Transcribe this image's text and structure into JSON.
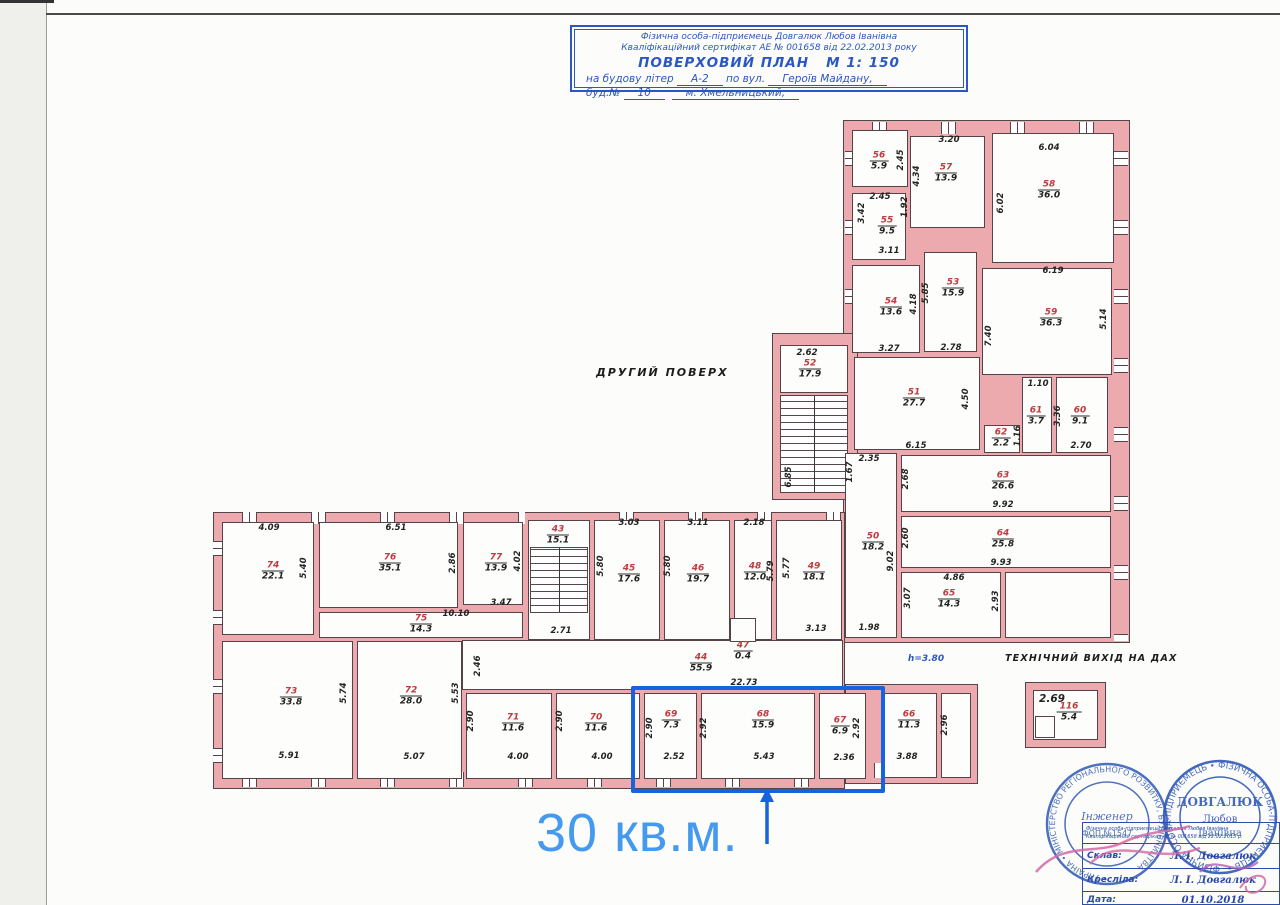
{
  "title": {
    "l1": "Фізична особа-підприємець Довгалюк Любов Іванівна",
    "l2": "Кваліфікаційний сертифікат АЕ № 001658 від 22.02.2013 року",
    "plan_name": "ПОВЕРХОВИЙ ПЛАН",
    "scale": "М 1: 150",
    "l4a": "на будову літер",
    "l4b": "А-2",
    "l4c": "по вул.",
    "l4d": "Героїв Майдану,",
    "l5a": "буд.№",
    "l5b": "10",
    "l5c": "м. Хмельницький,"
  },
  "plan": {
    "floor_label": "ДРУГИЙ ПОВЕРХ",
    "roof_exit_label": "ТЕХНІЧНИЙ ВИХІД НА ДАХ",
    "height_note": "h=3.80"
  },
  "annotation": {
    "area_text": "30 кв.м."
  },
  "rooms": [
    {
      "n": "56",
      "a": "5.9"
    },
    {
      "n": "57",
      "a": "13.9"
    },
    {
      "n": "58",
      "a": "36.0"
    },
    {
      "n": "55",
      "a": "9.5"
    },
    {
      "n": "54",
      "a": "13.6"
    },
    {
      "n": "53",
      "a": "15.9"
    },
    {
      "n": "59",
      "a": "36.3"
    },
    {
      "n": "52",
      "a": "17.9"
    },
    {
      "n": "51",
      "a": "27.7"
    },
    {
      "n": "61",
      "a": "3.7"
    },
    {
      "n": "60",
      "a": "9.1"
    },
    {
      "n": "62",
      "a": "2.2"
    },
    {
      "n": "63",
      "a": "26.6"
    },
    {
      "n": "64",
      "a": "25.8"
    },
    {
      "n": "50",
      "a": "18.2"
    },
    {
      "n": "65",
      "a": "14.3"
    },
    {
      "n": "74",
      "a": "22.1"
    },
    {
      "n": "76",
      "a": "35.1"
    },
    {
      "n": "77",
      "a": "13.9"
    },
    {
      "n": "75",
      "a": "14.3"
    },
    {
      "n": "43",
      "a": "15.1"
    },
    {
      "n": "45",
      "a": "17.6"
    },
    {
      "n": "46",
      "a": "19.7"
    },
    {
      "n": "48",
      "a": "12.0"
    },
    {
      "n": "49",
      "a": "18.1"
    },
    {
      "n": "73",
      "a": "33.8"
    },
    {
      "n": "72",
      "a": "28.0"
    },
    {
      "n": "71",
      "a": "11.6"
    },
    {
      "n": "70",
      "a": "11.6"
    },
    {
      "n": "69",
      "a": "7.3"
    },
    {
      "n": "68",
      "a": "15.9"
    },
    {
      "n": "67",
      "a": "6.9"
    },
    {
      "n": "66",
      "a": "11.3"
    },
    {
      "n": "44",
      "a": "55.9"
    },
    {
      "n": "47",
      "a": "0.4"
    },
    {
      "n": "116",
      "a": "5.4"
    }
  ],
  "dims": [
    "2.45",
    "2.45",
    "3.20",
    "4.34",
    "6.04",
    "6.02",
    "3.42",
    "1.92",
    "3.11",
    "4.18",
    "3.27",
    "5.85",
    "2.78",
    "6.19",
    "5.14",
    "7.40",
    "2.62",
    "6.85",
    "1.67",
    "4.50",
    "6.15",
    "1.10",
    "1.16",
    "3.36",
    "2.70",
    "2.35",
    "2.68",
    "9.92",
    "2.60",
    "9.93",
    "9.02",
    "4.86",
    "3.07",
    "2.93",
    "1.98",
    "3.13",
    "4.09",
    "5.40",
    "6.51",
    "2.86",
    "4.02",
    "3.47",
    "10.10",
    "2.71",
    "3.03",
    "5.80",
    "3.11",
    "5.80",
    "2.18",
    "5.79",
    "5.77",
    "5.74",
    "5.91",
    "5.53",
    "5.07",
    "2.46",
    "2.90",
    "4.00",
    "2.90",
    "4.00",
    "2.90",
    "2.52",
    "2.92",
    "5.43",
    "2.36",
    "2.92",
    "3.88",
    "2.96",
    "22.73",
    "2.69"
  ],
  "stamps": {
    "left": {
      "ring": "• УКРАЇНА • МІНІСТЕРСТВО РЕГІОНАЛЬНОГО РОЗВИТКУ, БУДІВНИЦТВА ",
      "center1": "Інженер",
      "center2": "ФОП №1547"
    },
    "right": {
      "ring": "ФІЗИЧНА ОСОБА-ПІДПРИЄМЕЦЬ  •  ФІЗИЧНА ОСОБА-ПІДПРИЄМЕЦЬ  •  ",
      "name": "ДОВГАЛЮК",
      "first": "Любов",
      "middle": "Іванівна"
    },
    "table": {
      "h1": "Фізична особа-підприємець Довгалюк Любов Іванівна",
      "h2": "Кваліфікаційний сертифікат АЕ № 001658 від 22.02.2013 р.",
      "rows": [
        {
          "label": "Склав:",
          "value": "Л. І. Довгалюк"
        },
        {
          "label": "Кресліла:",
          "value": "Л. І. Довгалюк"
        },
        {
          "label": "Дата:",
          "value": "01.10.2018"
        }
      ]
    }
  }
}
